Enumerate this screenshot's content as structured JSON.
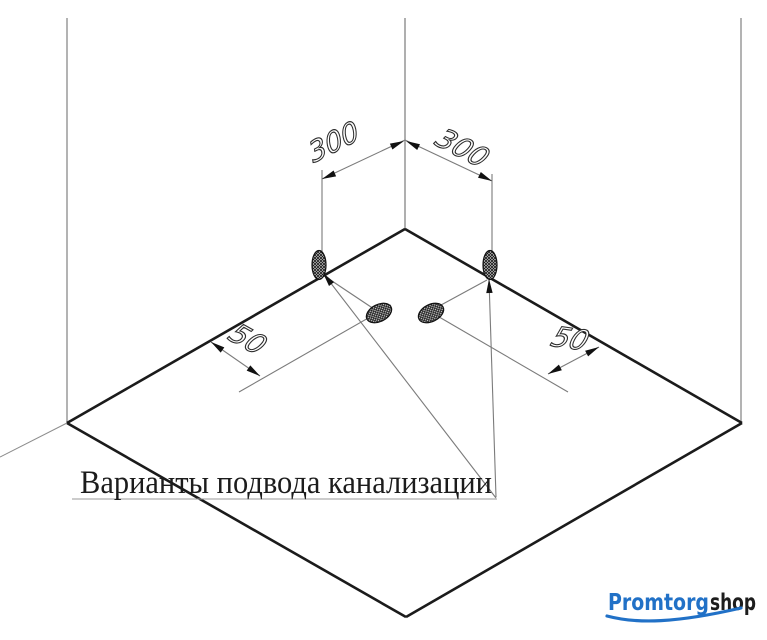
{
  "diagram": {
    "caption": "Варианты подвода канализации",
    "dimensions": {
      "left_300": "300",
      "right_300": "300",
      "left_50": "50",
      "right_50": "50"
    },
    "colors": {
      "thick_line": "#1b1b1b",
      "thin_line": "#7b7b7b",
      "wall_line": "#a0a0a0",
      "text": "#1c1c1c"
    }
  },
  "logo": {
    "part1": "Promtorg",
    "part2": "shop",
    "blue": "#2171c7",
    "dark": "#1d1d1d"
  }
}
